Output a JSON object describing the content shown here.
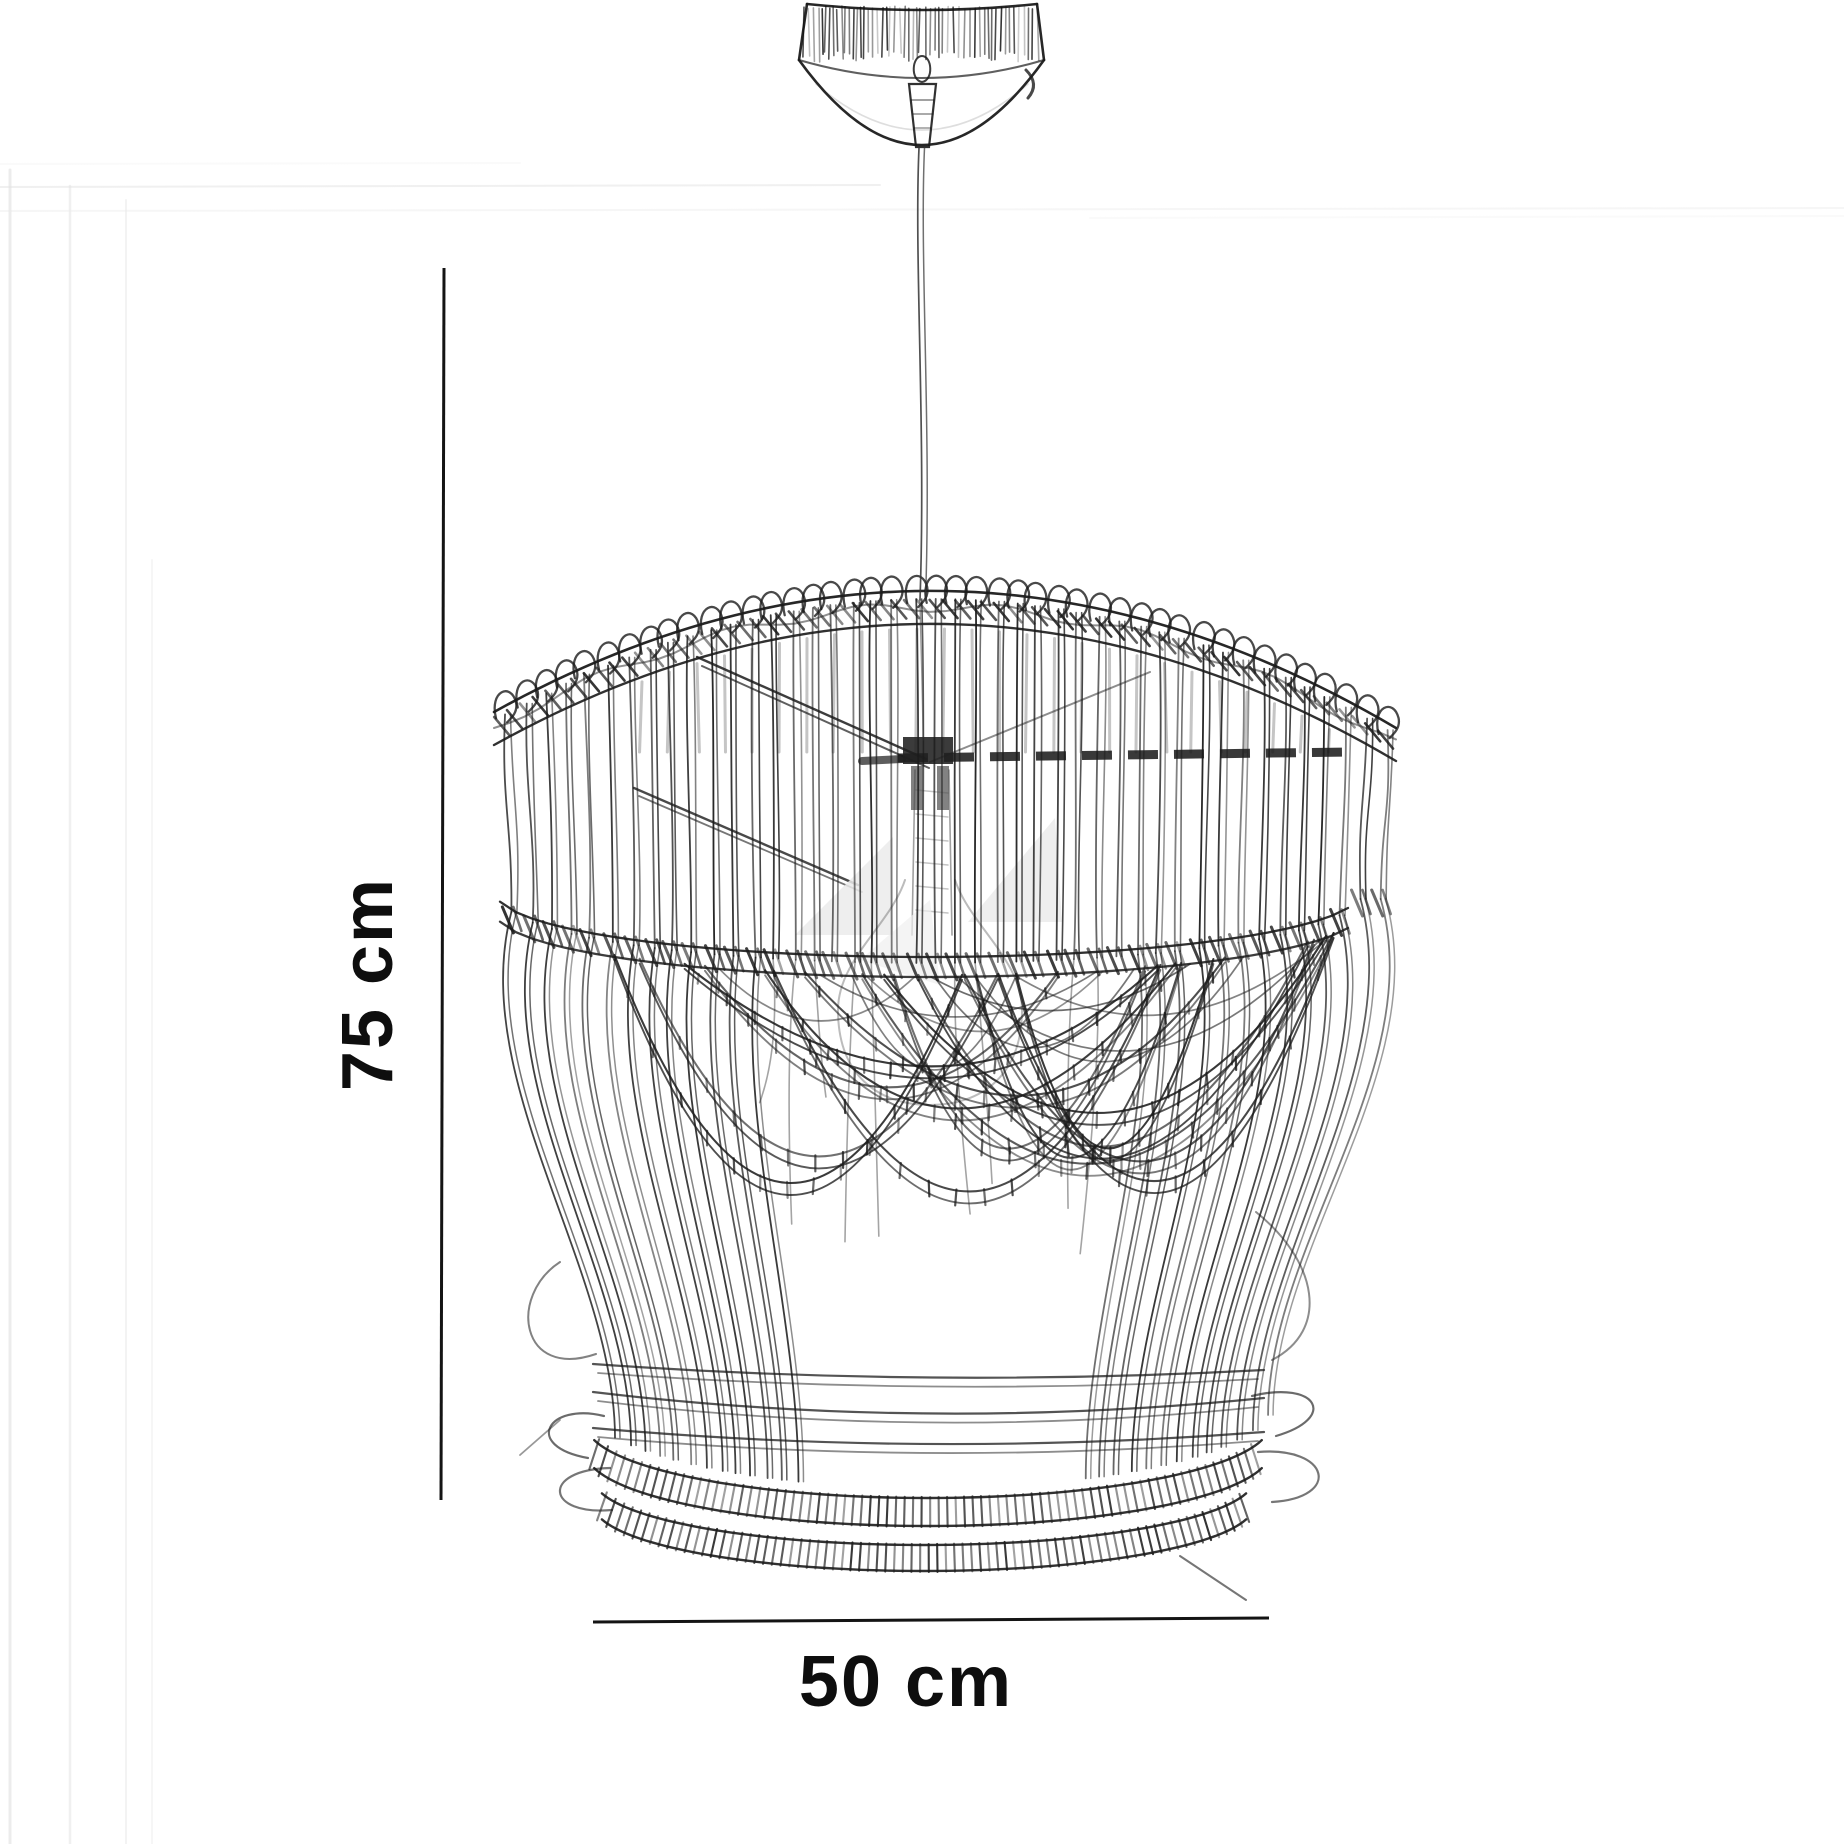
{
  "page": {
    "title": "Rattan pendant light dimension diagram"
  },
  "dimensions": {
    "height": {
      "label": "75 cm",
      "value_cm": 75,
      "unit": "cm"
    },
    "width": {
      "label": "50 cm",
      "value_cm": 50,
      "unit": "cm"
    }
  },
  "illustration": {
    "style": "black and white pencil sketch",
    "parts": [
      {
        "name": "ceiling-canopy"
      },
      {
        "name": "cord-grip"
      },
      {
        "name": "suspension-cord"
      },
      {
        "name": "woven-rattan-shade"
      },
      {
        "name": "light-bulb"
      },
      {
        "name": "bottom-coil-rings"
      }
    ]
  },
  "colors": {
    "ink": "#1b1b1b",
    "dimension_line": "#141414",
    "background": "#ffffff",
    "faint_wall_line": "#e6e6e6",
    "bulb_reflection": "#ebebeb"
  }
}
